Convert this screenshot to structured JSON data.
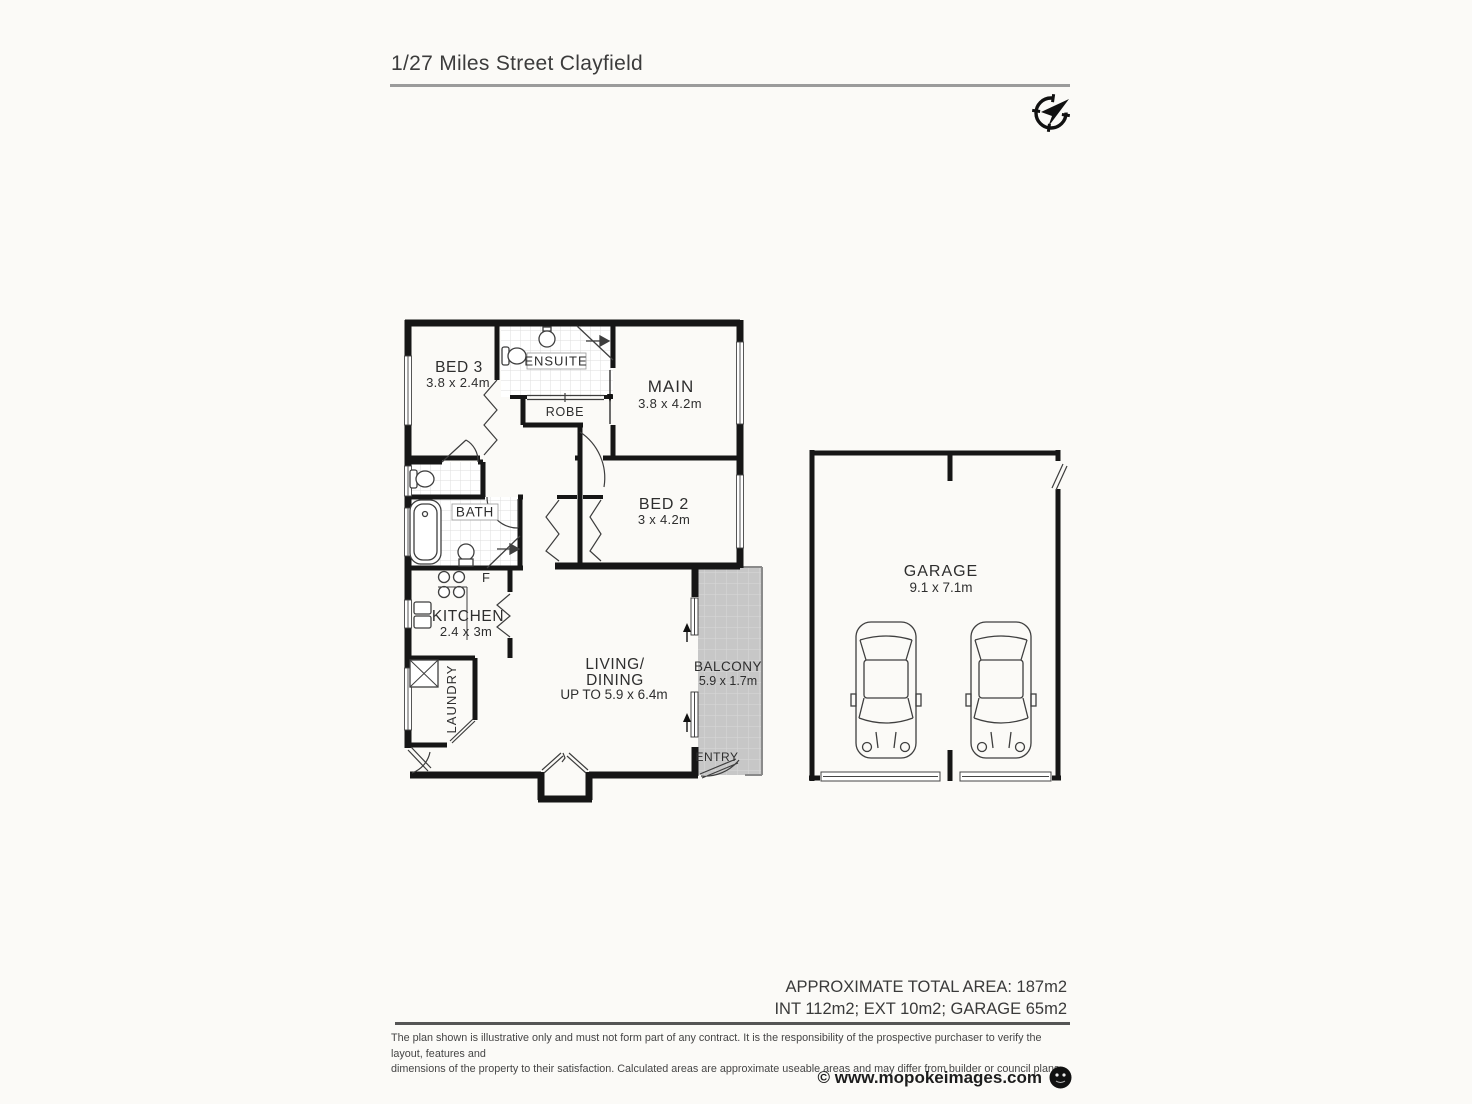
{
  "header": {
    "title": "1/27 Miles Street Clayfield"
  },
  "icons": {
    "compass": "compass-north-icon",
    "logo": "mopoke-owl-logo"
  },
  "plan": {
    "rooms": {
      "bed3": {
        "name": "BED 3",
        "dims": "3.8 x 2.4m"
      },
      "ensuite": {
        "name": "ENSUITE"
      },
      "robe": {
        "name": "ROBE"
      },
      "main": {
        "name": "MAIN",
        "dims": "3.8 x 4.2m"
      },
      "bed2": {
        "name": "BED 2",
        "dims": "3 x 4.2m"
      },
      "bath": {
        "name": "BATH"
      },
      "kitchen": {
        "name": "KITCHEN",
        "dims": "2.4 x 3m"
      },
      "laundry": {
        "name": "LAUNDRY"
      },
      "living": {
        "name_line1": "LIVING/",
        "name_line2": "DINING",
        "dims": "UP TO 5.9 x 6.4m"
      },
      "balcony": {
        "name": "BALCONY",
        "dims": "5.9 x 1.7m"
      },
      "entry": {
        "name": "ENTRY"
      },
      "garage": {
        "name": "GARAGE",
        "dims": "9.1 x 7.1m"
      }
    },
    "fixtures": {
      "fridge": "F"
    }
  },
  "summary": {
    "total": "APPROXIMATE TOTAL AREA: 187m2",
    "breakdown": "INT 112m2; EXT 10m2; GARAGE 65m2"
  },
  "disclaimer": {
    "line1": "The plan shown is illustrative only and must not form part of any contract. It is the responsibility of the prospective purchaser to verify the layout, features and",
    "line2": "dimensions of the property to their satisfaction. Calculated areas are approximate useable areas and may differ from builder or council plans."
  },
  "credit": {
    "text": "© www.mopokeimages.com"
  },
  "colors": {
    "wall": "#161616",
    "balcony_fill": "#c7c7c7",
    "divider_light": "#9b9b9b",
    "divider_dark": "#555555"
  }
}
